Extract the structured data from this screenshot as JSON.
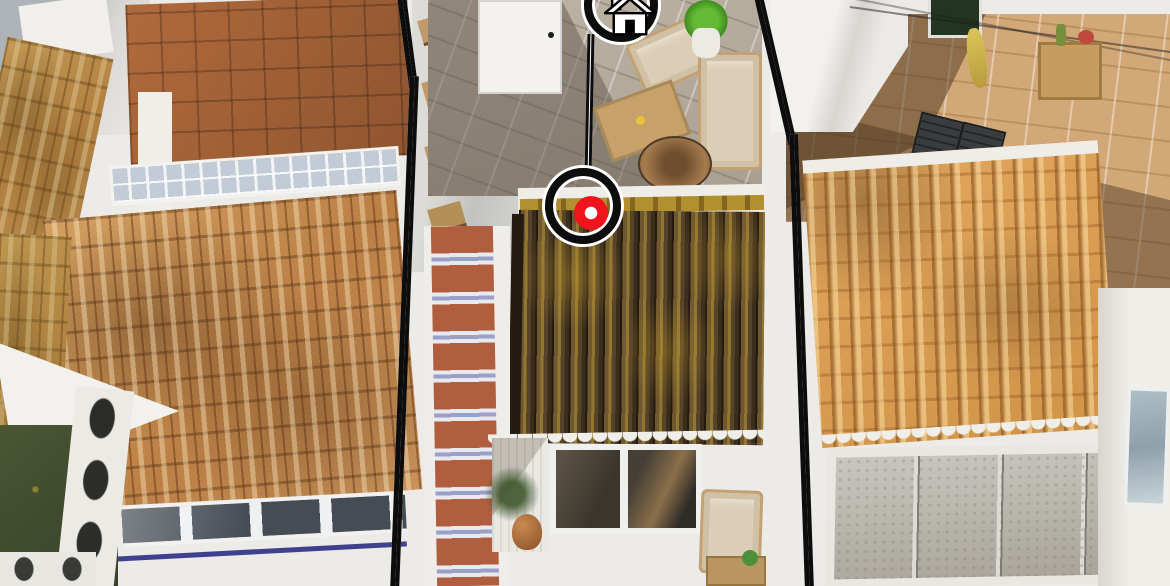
{
  "image_type": "aerial-drone-photo-with-property-highlight-overlay",
  "overlay": {
    "home_badge": {
      "icon": "home-icon",
      "icon_fill": "#ffffff",
      "icon_outline": "#000000"
    },
    "location_marker": {
      "icon": "target-dot",
      "dot_color": "#f0141c",
      "dot_hole_color": "#ffffff",
      "center_x_px": 591,
      "center_y_px": 214
    },
    "property_outline": {
      "stroke_color": "#0d0d0d",
      "inner_stripe_color": "#ffffff"
    }
  },
  "palette": {
    "white_wall": "#efede8",
    "terracotta_roof": "#c9925a",
    "orange_roof": "#d99d55",
    "mossy_roof_dark": "#53422a",
    "moss_lichen": "#a08228",
    "terrace_tile_tan": "#d2a878",
    "patio_tile_gray": "#aba294",
    "stair_tread_terracotta": "#b05e3e",
    "stair_riser_blue": "#9aa0c6",
    "shadow_brown": "#7b5a3e",
    "garden_green": "#44502e",
    "window_glass_dark": "#4b443b",
    "blue_trim_stripe": "#3f418f"
  }
}
